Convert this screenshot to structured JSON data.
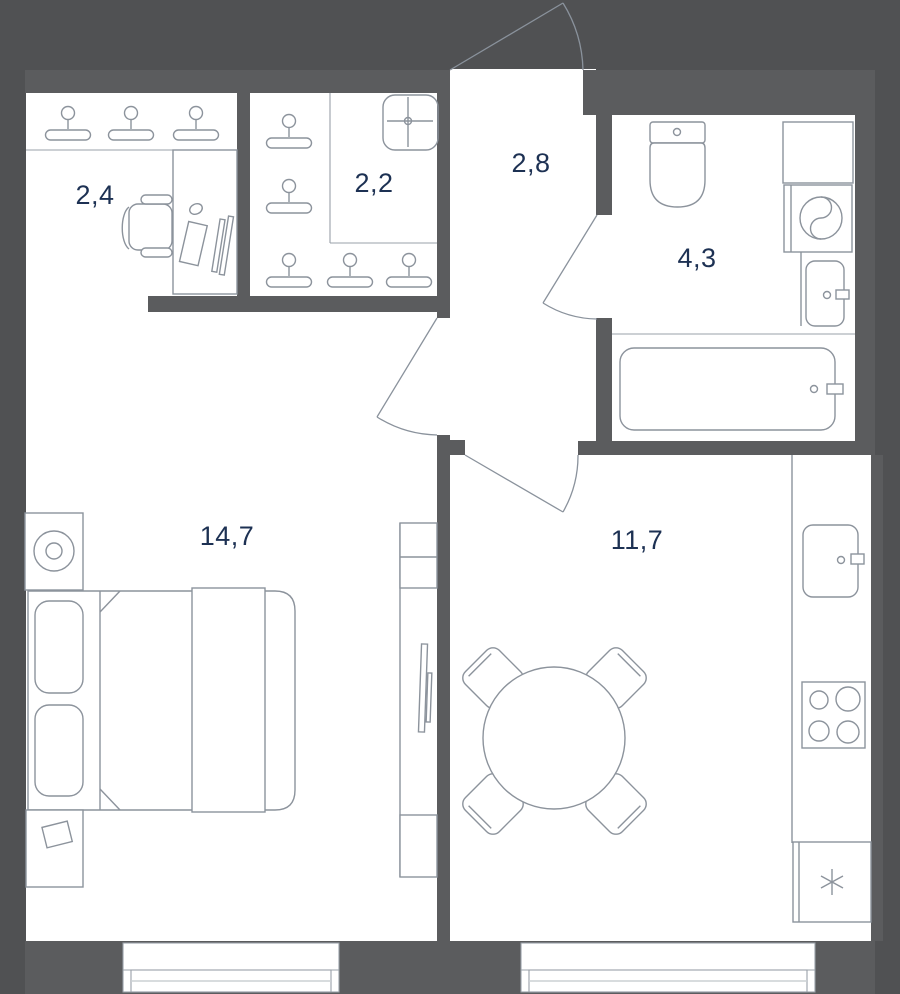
{
  "title": "Apartment floor plan",
  "colors": {
    "background": "#505153",
    "wall": "#5b5c5e",
    "floor": "#ffffff",
    "furniture_line": "#8c939c",
    "label_text": "#1d3153"
  },
  "rooms": [
    {
      "id": "dressing-room",
      "area_label": "2,4",
      "fixtures": [
        "hanger-icon",
        "hanger-icon",
        "hanger-icon",
        "desk",
        "office-chair",
        "monitor",
        "keyboard",
        "mouse"
      ]
    },
    {
      "id": "closet",
      "area_label": "2,2",
      "fixtures": [
        "hanger-icon",
        "hanger-icon",
        "hanger-icon",
        "hanger-icon",
        "hanger-icon",
        "ceiling-light-icon"
      ]
    },
    {
      "id": "hallway",
      "area_label": "2,8",
      "fixtures": [
        "entrance-door",
        "bathroom-door",
        "bedroom-door",
        "kitchen-door"
      ]
    },
    {
      "id": "bathroom",
      "area_label": "4,3",
      "fixtures": [
        "toilet-icon",
        "counter",
        "washing-machine-icon",
        "sink-icon",
        "bathtub-icon"
      ]
    },
    {
      "id": "bedroom",
      "area_label": "14,7",
      "fixtures": [
        "nightstand",
        "lamp-icon",
        "double-bed",
        "pillow",
        "pillow",
        "blanket",
        "nightstand",
        "tv-console",
        "tv"
      ]
    },
    {
      "id": "kitchen-living-room",
      "area_label": "11,7",
      "fixtures": [
        "dining-table",
        "chair",
        "chair",
        "chair",
        "chair",
        "kitchen-sink-icon",
        "cooktop-icon",
        "fridge-icon",
        "window"
      ]
    }
  ]
}
